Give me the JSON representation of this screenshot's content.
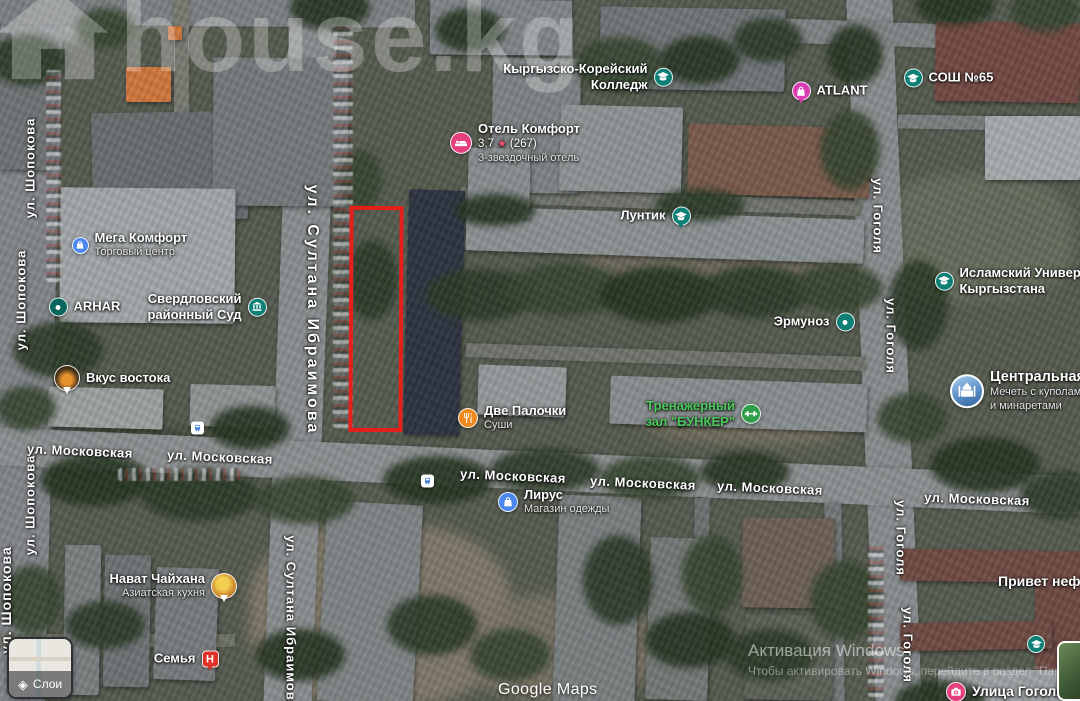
{
  "watermarks": {
    "house": "house.kg",
    "google": "Google Maps",
    "windows_line1": "Активация Windows",
    "windows_line2": "Чтобы активировать Windows, перейдите в раздел \"Пара"
  },
  "controls": {
    "layers_label": "Слои"
  },
  "icons": {
    "rating_star": "★",
    "layers": "◈"
  },
  "selection": {
    "outline_color": "#e51f1a"
  },
  "street_labels": [
    {
      "text": "ул. Шопокова"
    },
    {
      "text": "ул. Шопокова"
    },
    {
      "text": "ул. Шопокова"
    },
    {
      "text": "ул. Шопокова"
    },
    {
      "text": "ул. Султана Ибраимова"
    },
    {
      "text": "ул. Султана Ибраимова"
    },
    {
      "text": "ул. Гоголя"
    },
    {
      "text": "ул. Гоголя"
    },
    {
      "text": "ул. Гоголя"
    },
    {
      "text": "ул. Гоголя"
    },
    {
      "text": "ул. Московская"
    },
    {
      "text": "ул. Московская"
    },
    {
      "text": "ул. Московская"
    },
    {
      "text": "ул. Московская"
    },
    {
      "text": "ул. Московская"
    },
    {
      "text": "ул. Московская"
    }
  ],
  "pois": [
    {
      "id": "mega-komfort",
      "label": "Мега Комфорт",
      "sub": "Торговый центр"
    },
    {
      "id": "arhar",
      "label": "ARHAR"
    },
    {
      "id": "sverdlovsky-court",
      "label": "Свердловский",
      "label2": "районный Суд"
    },
    {
      "id": "vkus-vostoka",
      "label": "Вкус востока"
    },
    {
      "id": "hotel-komfort",
      "label": "Отель Комфорт",
      "rating": "3,7",
      "reviews": "(267)",
      "sub": "3-звездочный отель"
    },
    {
      "id": "kyrgyz-korean-college",
      "label": "Кыргызско-Корейский",
      "label2": "Колледж"
    },
    {
      "id": "luntik",
      "label": "Лунтик"
    },
    {
      "id": "atlant",
      "label": "ATLANT"
    },
    {
      "id": "sosh-65",
      "label": "СОШ №65"
    },
    {
      "id": "islamic-university",
      "label": "Исламский Университет",
      "label2": "Кыргызстана"
    },
    {
      "id": "ermunoz",
      "label": "Эрмуноз"
    },
    {
      "id": "central-mosque",
      "label": "Центральная Мечеть",
      "sub": "Мечеть с куполами",
      "sub2": "и минаретами"
    },
    {
      "id": "bunker-gym",
      "label": "Тренажерный",
      "label2": "зал \"БУНКЕР\""
    },
    {
      "id": "dve-palochki",
      "label": "Две Палочки",
      "sub": "Суши"
    },
    {
      "id": "lirus",
      "label": "Лирус",
      "sub": "Магазин одежды"
    },
    {
      "id": "navat-chaihana",
      "label": "Нават Чайхана",
      "sub": "Азиатская кухня"
    },
    {
      "id": "semya",
      "label": "Семья"
    },
    {
      "id": "privet-neform",
      "label": "Привет неформ"
    },
    {
      "id": "ulitsa-gogolya",
      "label": "Улица Гоголя"
    },
    {
      "id": "school-poi"
    },
    {
      "id": "bus-stop-1"
    },
    {
      "id": "bus-stop-2"
    }
  ]
}
